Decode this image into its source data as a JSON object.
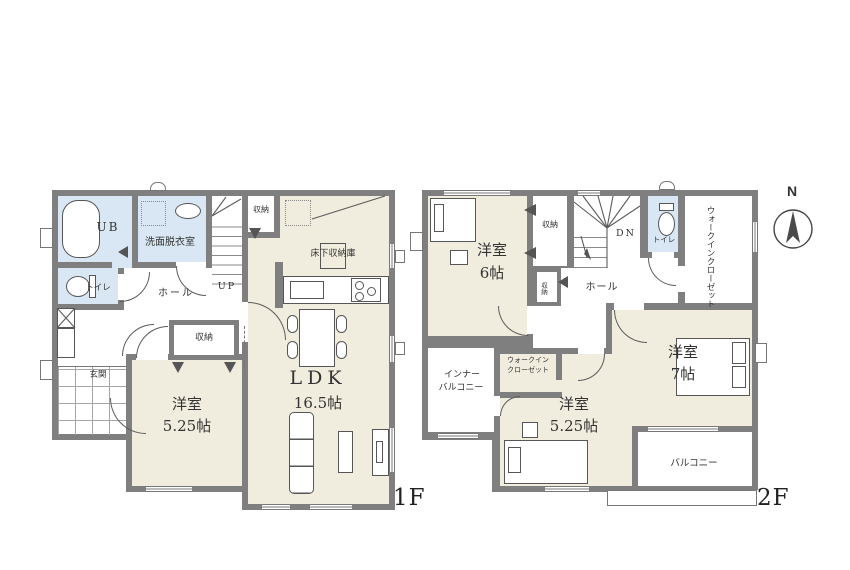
{
  "colors": {
    "wall": "#7f7f7f",
    "cream": "#f0edde",
    "blue": "#d8e7f3",
    "line": "#565656",
    "text": "#333333"
  },
  "compass": {
    "label": "N"
  },
  "floor1": {
    "tag": "1F",
    "labels": {
      "ub": "UB",
      "senmen": "洗面脱衣室",
      "toilet": "トイレ",
      "hall": "ホール",
      "up": "UP",
      "shuno_stairs": "収納",
      "shuno_mid": "収納",
      "genkan": "玄関",
      "yoshitsu_name": "洋室",
      "yoshitsu_size": "5.25帖",
      "ldk_name": "LDK",
      "ldk_size": "16.5帖",
      "yukashita": "床下収納庫"
    }
  },
  "floor2": {
    "tag": "2F",
    "labels": {
      "yoshitsu6_name": "洋室",
      "yoshitsu6_size": "6帖",
      "shuno_a": "収納",
      "shuno_b": "収納",
      "dn": "DN",
      "toilet": "トイレ",
      "wic_main": "ウォークインクローゼット",
      "hall": "ホール",
      "inner_balcony_line1": "インナー",
      "inner_balcony_line2": "バルコニー",
      "wic_small_line1": "ウォークイン",
      "wic_small_line2": "クローゼット",
      "yoshitsu525_name": "洋室",
      "yoshitsu525_size": "5.25帖",
      "yoshitsu7_name": "洋室",
      "yoshitsu7_size": "7帖",
      "balcony": "バルコニー"
    }
  }
}
